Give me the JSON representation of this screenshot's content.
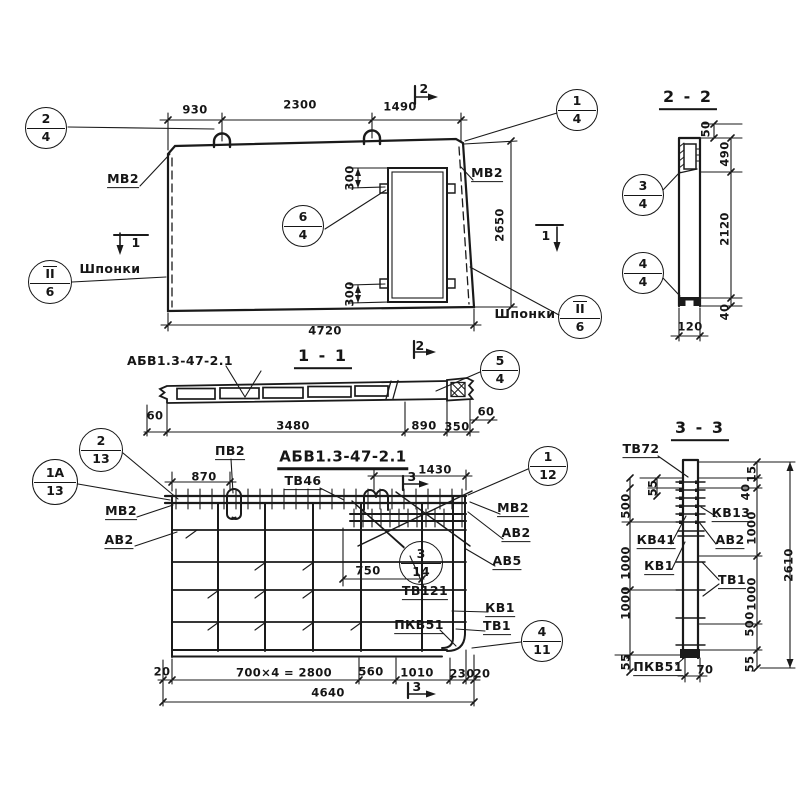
{
  "callouts": [
    {
      "top": "2",
      "bottom": "4"
    },
    {
      "top": "1",
      "bottom": "4"
    },
    {
      "top": "6",
      "bottom": "4"
    },
    {
      "top": "II",
      "bottom": "6"
    },
    {
      "top": "II",
      "bottom": "6"
    },
    {
      "top": "5",
      "bottom": "4"
    },
    {
      "top": "2",
      "bottom": "13"
    },
    {
      "top": "1А",
      "bottom": "13"
    },
    {
      "top": "1",
      "bottom": "12"
    },
    {
      "top": "3",
      "bottom": "14"
    },
    {
      "top": "4",
      "bottom": "11"
    },
    {
      "top": "3",
      "bottom": "4"
    },
    {
      "top": "4",
      "bottom": "4"
    }
  ],
  "plan": {
    "dims": {
      "a": "930",
      "b": "2300",
      "c": "1490",
      "h": "2650",
      "w": "4720",
      "o1": "300",
      "o2": "300"
    },
    "labels": {
      "mv2": "МВ2",
      "shponki": "Шпонки"
    },
    "marks": {
      "m1": "1",
      "m2": "2"
    }
  },
  "sec11": {
    "title": "1 - 1",
    "label": "АБВ1.3-47-2.1",
    "mark2": "2",
    "dims": {
      "e1": "60",
      "l": "3480",
      "m": "890",
      "n": "350",
      "e2": "60"
    }
  },
  "sec22": {
    "title": "2 - 2",
    "dims": {
      "a": "50",
      "b": "490",
      "c": "2120",
      "d": "40",
      "w": "120"
    }
  },
  "rebar": {
    "title": "АБВ1.3-47-2.1",
    "marks": {
      "m3": "3"
    },
    "dims": {
      "a": "870",
      "b": "1430",
      "c": "750",
      "e1": "20",
      "mod": "700×4 = 2800",
      "f": "560",
      "g": "1010",
      "h": "230",
      "e2": "20",
      "total": "4640"
    },
    "labels": {
      "pv2": "ПВ2",
      "tv46": "ТВ46",
      "mv2": "МВ2",
      "av2": "АВ2",
      "av5": "АВ5",
      "tv121": "ТВ121",
      "kv1": "КВ1",
      "tv1": "ТВ1",
      "pkv51": "ПКВ51"
    }
  },
  "sec33": {
    "title": "3 - 3",
    "labels": {
      "tv72": "ТВ72",
      "kv13": "КВ13",
      "kv41": "КВ41",
      "av2": "АВ2",
      "kv1": "КВ1",
      "tv1": "ТВ1",
      "pkv51": "ПКВ51"
    },
    "left": [
      "55",
      "500",
      "1000",
      "1000",
      "55"
    ],
    "right": [
      "15",
      "40",
      "1000",
      "1000",
      "500",
      "55"
    ],
    "total": "2610",
    "bottom": "70"
  }
}
